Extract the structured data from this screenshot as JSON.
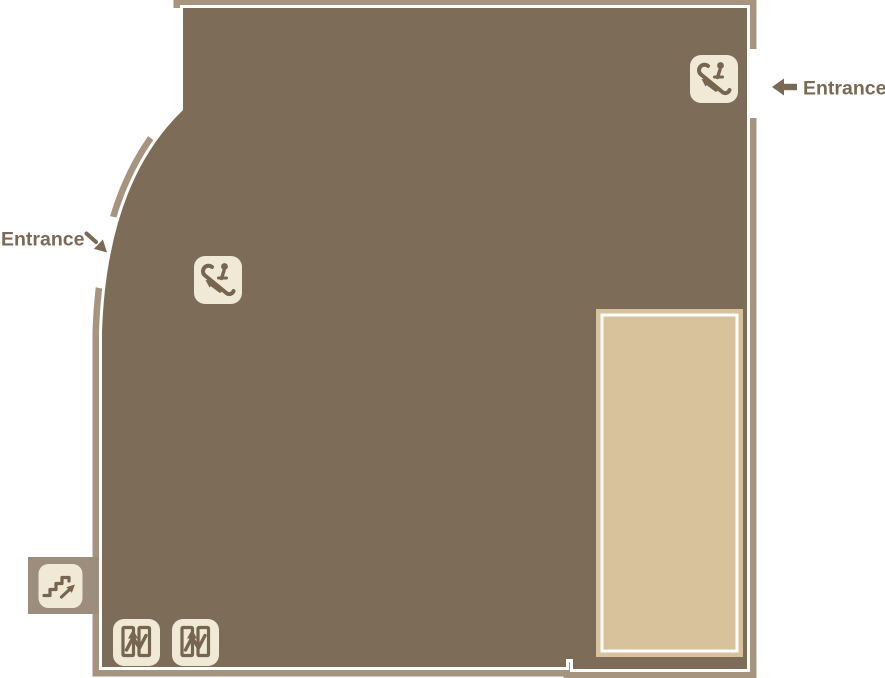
{
  "map": {
    "name": "store floor map",
    "labels": {
      "entrance_right": "Entrance",
      "entrance_left": "Entrance"
    },
    "icons": {
      "escalator_top_right": "escalator-icon",
      "escalator_center": "escalator-icon",
      "stairs_bottom_left": "stairs-icon",
      "elevator_left": "elevator-icon",
      "elevator_right": "elevator-icon"
    },
    "colors": {
      "background": "#FFFFFF",
      "floor": "#7D6C57",
      "outline": "#A6947E",
      "inner_line": "#FFFFFF",
      "stairs_block": "#9D8D7D",
      "icon_bg": "#EFE9D6",
      "icon_fg": "#76654F",
      "highlight_area": "#D7C29C",
      "label_text": "#7A6954"
    }
  }
}
